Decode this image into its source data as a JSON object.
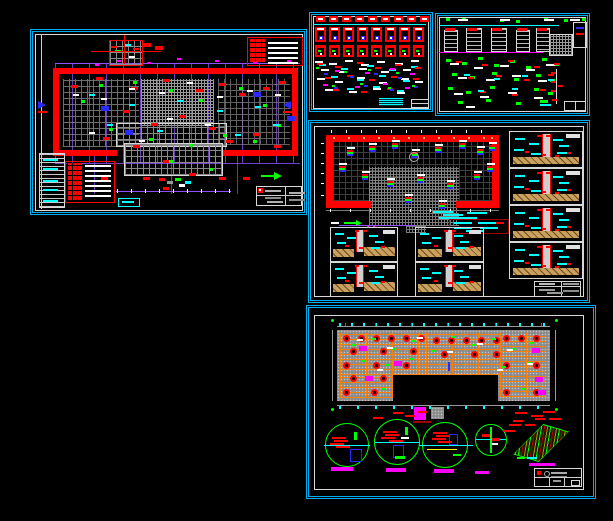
{
  "app": {
    "name": "cad-multi-sheet-view",
    "background": "#000000"
  },
  "palette": {
    "border": "#00aeef",
    "red": "#ff0000",
    "darkred": "#a00000",
    "cyan": "#00ffff",
    "green": "#00ff00",
    "magenta": "#ff00ff",
    "orange": "#ff8000",
    "purple": "#8d4fff",
    "blue": "#2a2aff",
    "yellow": "#ffff00",
    "tan": "#c8a060",
    "gray": "#9a9a9a",
    "white": "#ffffff"
  },
  "sheets": [
    {
      "id": "sheet-1",
      "name": "floor-plan-sheet"
    },
    {
      "id": "sheet-2",
      "name": "detail-grid-sheet"
    },
    {
      "id": "sheet-3",
      "name": "green-detail-sheet"
    },
    {
      "id": "sheet-4",
      "name": "foundation-plan-and-sections-sheet"
    },
    {
      "id": "sheet-5",
      "name": "framing-plan-and-callouts-sheet"
    }
  ]
}
